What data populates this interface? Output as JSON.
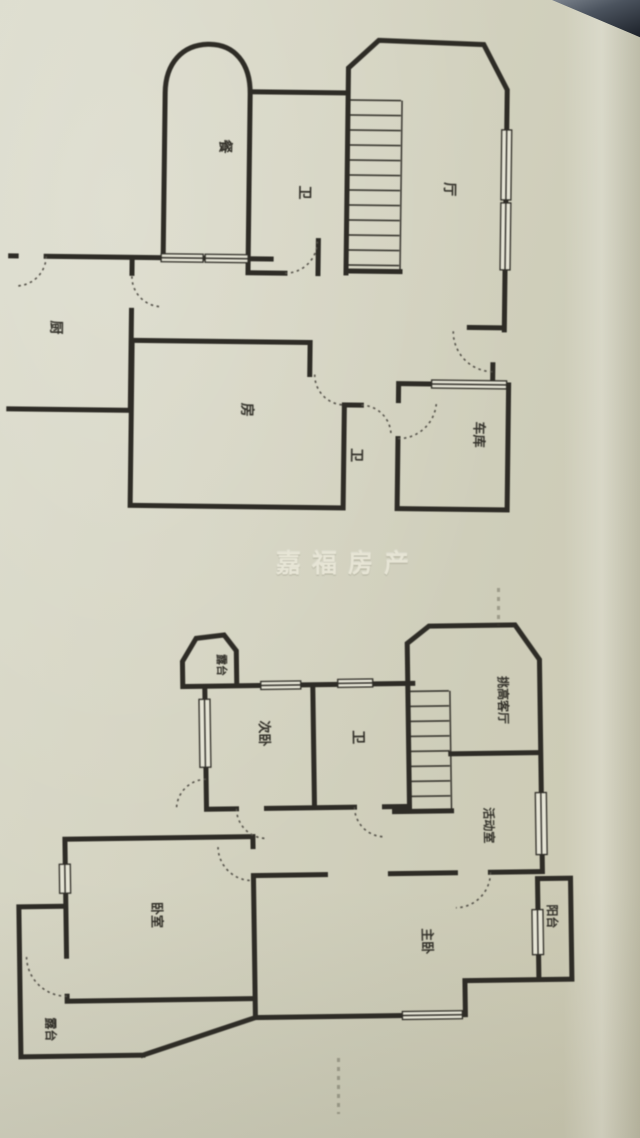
{
  "photo": {
    "watermark": "嘉福房产"
  },
  "floor1": {
    "rooms": [
      {
        "label": "餐"
      },
      {
        "label": "卫"
      },
      {
        "label": "厅"
      },
      {
        "label": "厨"
      },
      {
        "label": "房"
      },
      {
        "label": "卫"
      },
      {
        "label": "车库"
      }
    ]
  },
  "floor2": {
    "rooms": [
      {
        "label": "露台"
      },
      {
        "label": "次卧"
      },
      {
        "label": "卫"
      },
      {
        "label": "挑高客厅"
      },
      {
        "label": "活动室"
      },
      {
        "label": "卧室"
      },
      {
        "label": "主卧"
      },
      {
        "label": "阳台"
      },
      {
        "label": "露台"
      }
    ]
  },
  "colors": {
    "paper": "#d3d2c0",
    "ink": "#2e2c26",
    "watermark": "#eceadb"
  }
}
